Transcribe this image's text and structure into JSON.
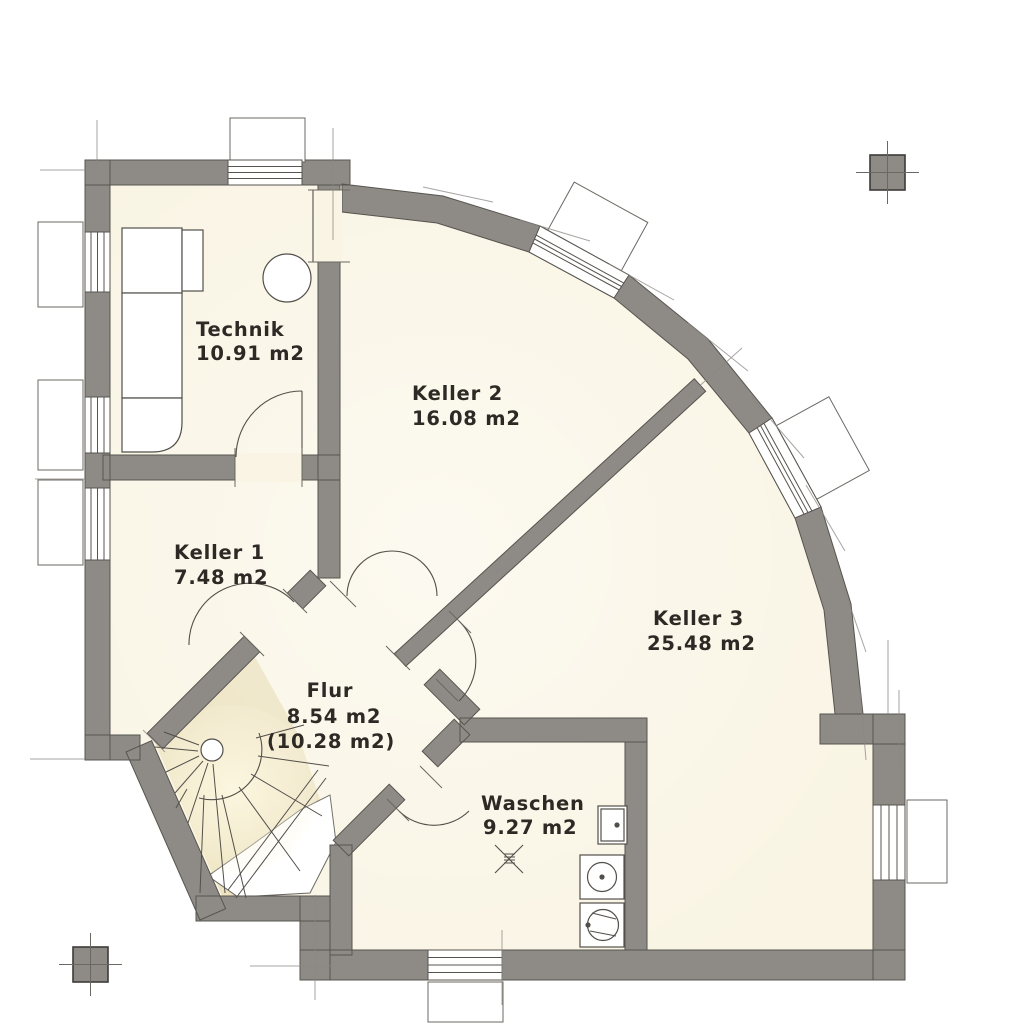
{
  "plan": {
    "rooms": [
      {
        "name": "Technik",
        "area": "10.91 m2"
      },
      {
        "name": "Keller 2",
        "area": "16.08 m2"
      },
      {
        "name": "Keller 1",
        "area": "7.48 m2"
      },
      {
        "name": "Keller 3",
        "area": "25.48 m2"
      },
      {
        "name": "Flur",
        "area": "8.54 m2",
        "area_secondary": "(10.28 m2)"
      },
      {
        "name": "Waschen",
        "area": "9.27 m2"
      }
    ],
    "colors": {
      "background": "#ffffff",
      "wall_fill": "#8e8b86",
      "wall_outline": "#57544f",
      "floor_fill": "#f9f4e3",
      "stair_fill": "#ebe0ba",
      "label_text": "#2d2a26"
    },
    "fixtures": [
      "heating-tank",
      "boiler",
      "spiral-staircase",
      "floor-drain",
      "sink",
      "washing-machine",
      "tumble-dryer"
    ],
    "markers": [
      "column-marker-top-right",
      "column-marker-bottom-left"
    ]
  }
}
